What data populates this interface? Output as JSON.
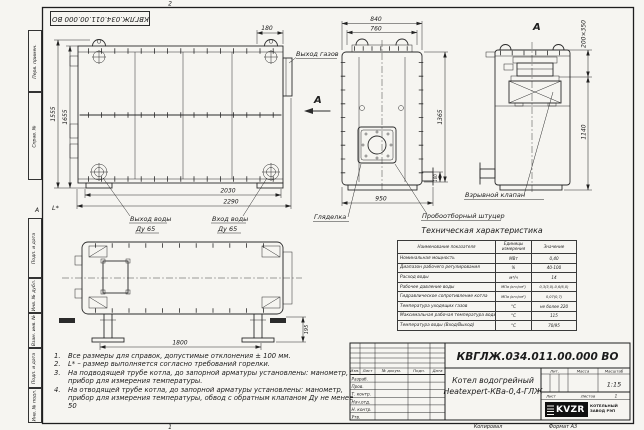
{
  "frame": {
    "doc_number_top": "КВГЛЖ.034.011.00.000 ВО",
    "zone_top": "2",
    "zone_bottom": "1",
    "zone_left": "А",
    "margin_stamps": [
      "Перв. примен.",
      "Справ. №",
      "Подп. и дата",
      "Инв. № дубл.",
      "Взам. инв. №",
      "Подп. и дата",
      "Инв. № подл."
    ]
  },
  "views": {
    "side": {
      "dim_height_outer": "1555",
      "dim_height_inner": "1655",
      "dim_top_right": "180",
      "dim_width_inner": "2030",
      "dim_width_outer": "2290",
      "label_gas_outlet": "Выход газов",
      "view_arrow_letter": "А",
      "label_burner_size": "L*",
      "water_outlet_line1": "Выход воды",
      "water_outlet_line2": "Ду 65",
      "water_inlet_line1": "Вход воды",
      "water_inlet_line2": "Ду 65"
    },
    "front": {
      "dim_width_outer": "840",
      "dim_width_inner": "760",
      "dim_height": "1365",
      "dim_stub": "100",
      "dim_width_bottom": "950",
      "label_sight_glass": "Гляделка",
      "label_sampling": "Пробоотборный штуцер"
    },
    "rear": {
      "view_letter": "А",
      "dim_slot": "200×350",
      "dim_height": "1140",
      "label_explosion_valve": "Взрывной клапан"
    },
    "plan": {
      "dim_width": "1800",
      "dim_support_height": "195"
    }
  },
  "spec_table": {
    "title": "Техническая характеристика",
    "headers": [
      "Наименование показателя",
      "Единицы измерения",
      "Значение"
    ],
    "rows": [
      {
        "name": "Номинальная мощность",
        "unit": "МВт",
        "value": "0,40"
      },
      {
        "name": "Диапазон рабочего регулирования",
        "unit": "%",
        "value": "40-100"
      },
      {
        "name": "Расход воды",
        "unit": "м³/ч",
        "value": "14"
      },
      {
        "name": "Рабочее давление воды",
        "unit": "МПа (кгс/см²)",
        "value": "0,3(3,0)-0,6(6,0)"
      },
      {
        "name": "Гидравлическое сопротивление котла",
        "unit": "МПа (кгс/см²)",
        "value": "0,07(0,7)"
      },
      {
        "name": "Температура уходящих газов",
        "unit": "°С",
        "value": "не более 220"
      },
      {
        "name": "Максимальная рабочая температура воды",
        "unit": "°С",
        "value": "115"
      },
      {
        "name": "Температура воды (Вход/Выход)",
        "unit": "°С",
        "value": "70/95"
      }
    ]
  },
  "notes": {
    "items": [
      {
        "num": "1.",
        "text": "Все размеры для справок, допустимые отклонения ± 100 мм."
      },
      {
        "num": "2.",
        "text": "L* – размер выполняется согласно требований горелки."
      },
      {
        "num": "3.",
        "text": "На подводящей трубе котла, до запорной арматуры установлены: манометр, прибор для измерения температуры."
      },
      {
        "num": "4.",
        "text": "На отводящей трубе котла, до запорной арматуры установлены: манометр, прибор для измерения температуры, обвод с обратным клапаном Ду не менее 50"
      }
    ]
  },
  "title_block": {
    "doc_number": "КВГЛЖ.034.011.00.000 ВО",
    "product_line1": "Котел водогрейный",
    "product_line2": "Heatexpert-КВа-0,4-ГЛЖ",
    "header_cols": [
      "Изм.",
      "Лист",
      "№ докум.",
      "Подп.",
      "Дата"
    ],
    "roles": [
      "Разраб.",
      "Пров.",
      "Т. контр.",
      "Нач.отд.",
      "Н. контр.",
      "Утв."
    ],
    "lit_label": "Лит.",
    "mass_label": "Масса",
    "scale_label": "Масштаб",
    "scale_value": "1:15",
    "sheet_label": "Лист",
    "sheets_label": "Листов",
    "sheets_value": "1",
    "logo_text": "KVZR",
    "company_line1": "КОТЕЛЬНЫЙ",
    "company_line2": "ЗАВОД РЭП",
    "copied_label": "Копировал",
    "format_label": "Формат А3"
  },
  "colors": {
    "line": "#2b2b2b",
    "paper": "#f6f5f1",
    "logo_bg": "#101010"
  }
}
